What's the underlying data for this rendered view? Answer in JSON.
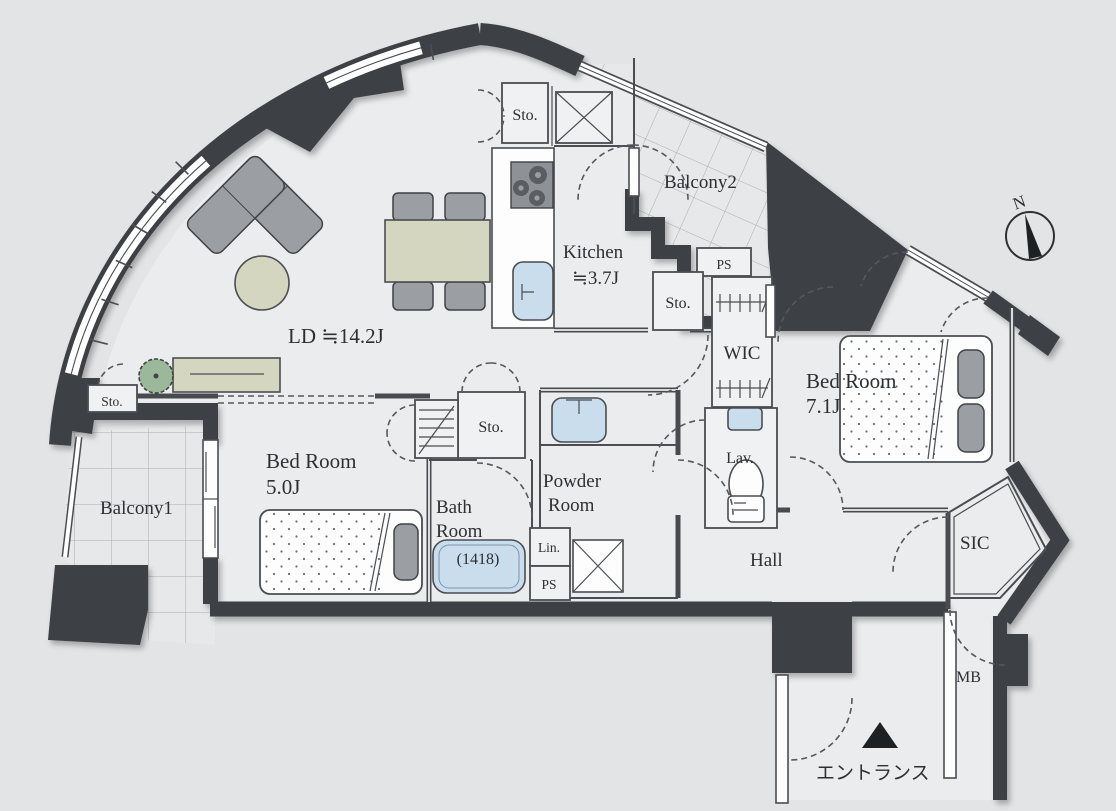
{
  "colors": {
    "wall": "#3d4045",
    "line": "#4a4d52",
    "floor": "#ebecee",
    "outside": "#e3e4e6",
    "balcony": "#e7e8ea",
    "fixture": "#c9dded",
    "furniture": "#d5d6c0",
    "gray": "#9b9ea3",
    "plant": "#9cb89a",
    "stove": "#8e9195",
    "text": "#2c2f33"
  },
  "compass": {
    "north_label": "N"
  },
  "rooms": {
    "living_dining": {
      "label": "LD ≒14.2J"
    },
    "kitchen": {
      "name": "Kitchen",
      "size": "≒3.7J"
    },
    "bedroom_main": {
      "name": "Bed Room",
      "size": "7.1J"
    },
    "bedroom_second": {
      "name": "Bed Room",
      "size": "5.0J"
    },
    "bathroom": {
      "name_line1": "Bath",
      "name_line2": "Room",
      "size": "(1418)"
    },
    "powder_room": {
      "name_line1": "Powder",
      "name_line2": "Room"
    },
    "lavatory": {
      "label": "Lav."
    },
    "hall": {
      "label": "Hall"
    },
    "balcony1": {
      "label": "Balcony1"
    },
    "balcony2": {
      "label": "Balcony2"
    },
    "wic": {
      "label": "WIC"
    },
    "sic": {
      "label": "SIC"
    },
    "entrance": {
      "label": "エントランス"
    }
  },
  "storage": {
    "sto_kitchen_top": "Sto.",
    "sto_kitchen_side": "Sto.",
    "sto_hallway": "Sto.",
    "sto_ld_corner": "Sto."
  },
  "utility": {
    "ps_top": "PS",
    "ps_bottom": "PS",
    "linen": "Lin.",
    "meter_box": "MB"
  }
}
